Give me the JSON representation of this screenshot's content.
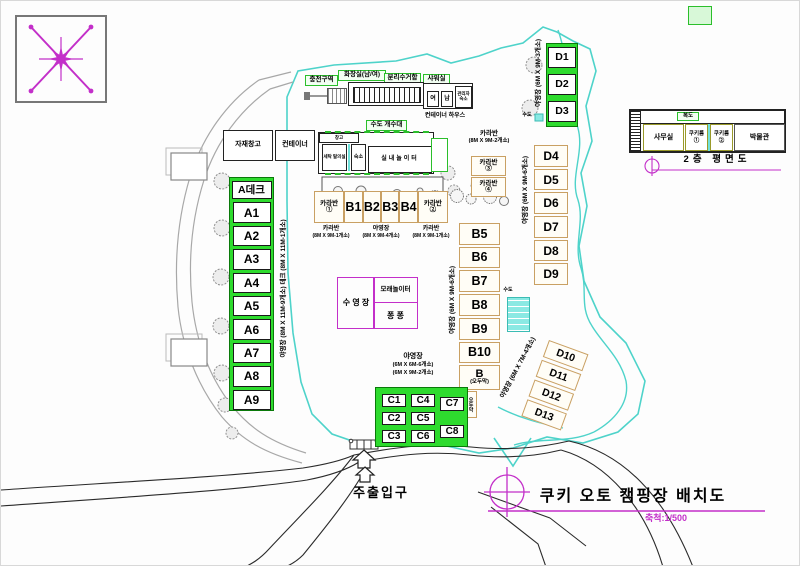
{
  "doc": {
    "title": "쿠키 오토 캠핑장 배치도",
    "scale": "축척:1/500",
    "entrance": "주출입구",
    "floor2_caption": "2층 평면도"
  },
  "facilities": {
    "charging": "충전구역",
    "toilet": "화장실(남/여)",
    "recycling": "분리수거함",
    "shower": "샤워실",
    "shower_f": "여",
    "shower_m": "남",
    "manager": "관리자 숙소",
    "sink": "수도 개수대",
    "container_house": "컨테이너 하우스",
    "storage": "자재창고",
    "container": "컨테이너",
    "mb_top": "창고",
    "mb_laundry": "세탁 탈의실",
    "mb_lodge": "숙소",
    "mb_playroom": "실내놀이터",
    "pool": "수 영 장",
    "sand": "모래놀이터",
    "pong": "퐁 퐁",
    "water_top": "수도",
    "water_mid": "수도",
    "hut_small": "오두막"
  },
  "caravan_row": {
    "items": [
      "카라반①",
      "B1",
      "B2",
      "B3",
      "B4",
      "카라반②"
    ],
    "legends": [
      {
        "name": "카라반",
        "size": "(8M X 9M-1개소)"
      },
      {
        "name": "야영장",
        "size": "(8M X 9M-4개소)"
      },
      {
        "name": "카라반",
        "size": "(8M X 9M-1개소)"
      }
    ]
  },
  "caravan34": {
    "name": "카라반",
    "size": "(8M X 9M-2개소)",
    "items": [
      "카라반③",
      "카라반④"
    ]
  },
  "a_zone": {
    "header": "A데크",
    "items": [
      "A1",
      "A2",
      "A3",
      "A4",
      "A5",
      "A6",
      "A7",
      "A8",
      "A9"
    ],
    "legend_deck": "데크 (8M X 11M-1개소)",
    "legend_camp": "야영장 (8M X 11M-9개소)"
  },
  "b_zone": {
    "items": [
      "B5",
      "B6",
      "B7",
      "B8",
      "B9",
      "B10"
    ],
    "hut": "B",
    "hut_sub": "(오두막)",
    "legend": "야영장 (6M X 9M-6개소)"
  },
  "c_zone": {
    "name": "야영장",
    "size1": "(6M X 6M-6개소)",
    "size2": "(6M X 9M-2개소)",
    "items": [
      "C1",
      "C4",
      "C7",
      "C2",
      "C5",
      "C3",
      "C6",
      "C8"
    ]
  },
  "d123": {
    "items": [
      "D1",
      "D2",
      "D3"
    ],
    "legend": "야영장 (6M X 9M-3개소)"
  },
  "d49": {
    "items": [
      "D4",
      "D5",
      "D6",
      "D7",
      "D8",
      "D9"
    ],
    "legend": "야영장 (6M X 9M-6개소)"
  },
  "d1013": {
    "items": [
      "D10",
      "D11",
      "D12",
      "D13"
    ],
    "legend": "야영장 (6M X 7M-4개소)"
  },
  "floor2": {
    "corridor": "복도",
    "rooms": [
      "사무실",
      "쿠키룸①",
      "쿠키룸②",
      "박물관"
    ]
  },
  "colors": {
    "site_green": "#2edb2e",
    "tan_border": "#c9a063",
    "magenta": "#c32fc9",
    "stream_cyan": "#4ed3ca"
  }
}
